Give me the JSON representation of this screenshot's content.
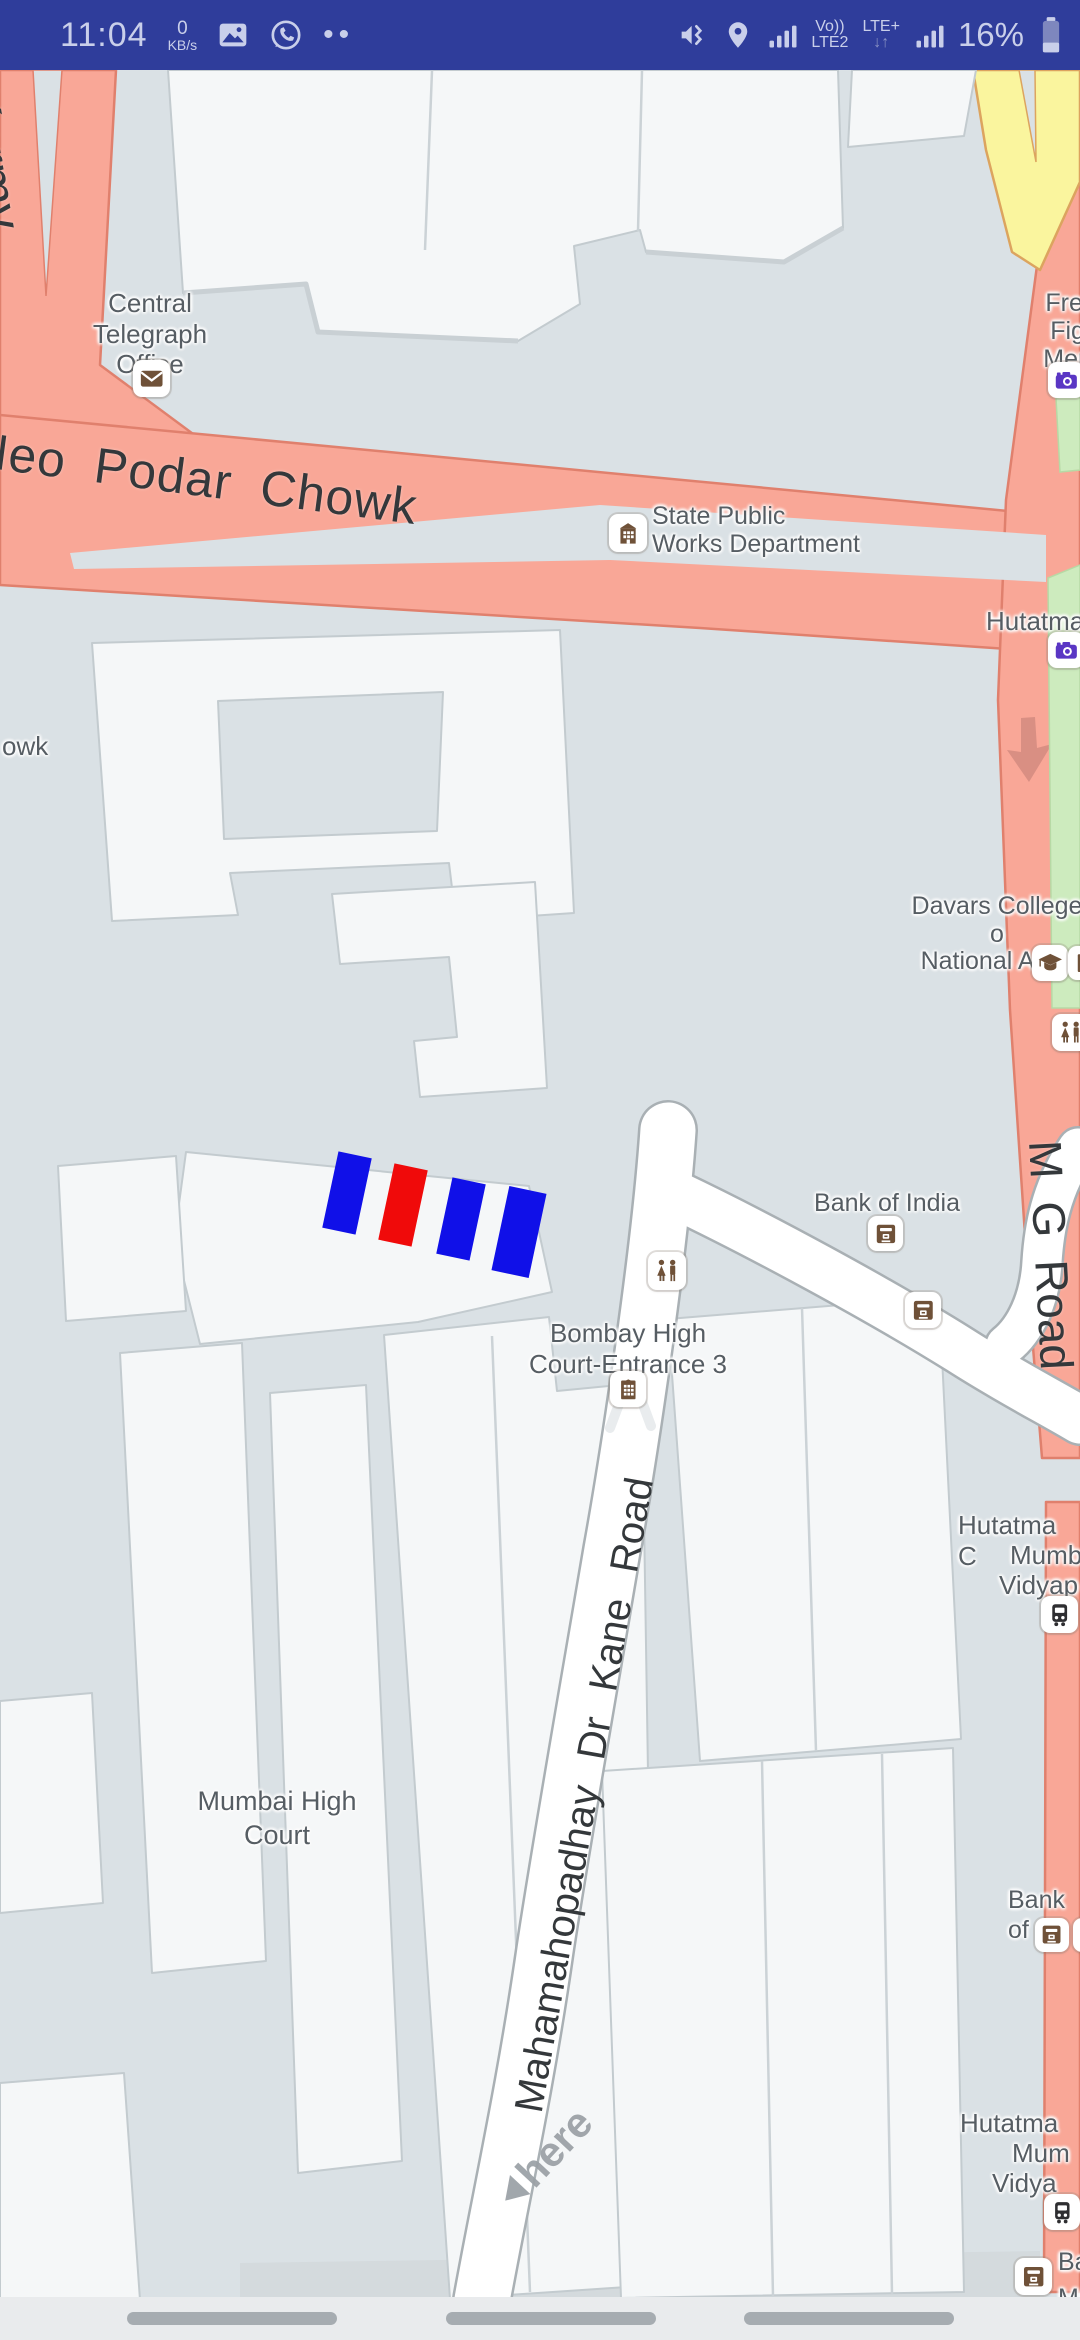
{
  "status_bar": {
    "time": "11:04",
    "net_speed_value": "0",
    "net_speed_unit": "KB/s",
    "notification_dots": "••",
    "volte_top": "Vo))",
    "volte_bottom": "LTE2",
    "lte_top": "LTE+",
    "lte_arrows": "↓↑",
    "battery_percent": "16%",
    "bg_color": "#2F3D9B",
    "icons": [
      "image-notification-icon",
      "whatsapp-notification-icon",
      "vibrate-icon",
      "location-icon",
      "signal-bars-icon",
      "signal-bars-icon",
      "battery-icon"
    ]
  },
  "map": {
    "attribution": "here",
    "road_labels": {
      "karmveer": "Karmv",
      "podar_chowk": "Neo Podar Chowk",
      "chowk_fragment": "owk",
      "mg_road": "M G Road",
      "kane_road": "Mahamahopadhay Dr Kane Road"
    },
    "poi": {
      "central_telegraph_office": {
        "label": "Central\nTelegraph\nOffice",
        "icon": "post-office"
      },
      "state_pwd": {
        "label": "State Public\nWorks Department",
        "icon": "government-building"
      },
      "freedom_fighters_memorial": {
        "label": "Freed\nFight\nMemo",
        "icon": "camera"
      },
      "hutatma_top": {
        "label": "Hutatma",
        "icon": "camera"
      },
      "davars_college": {
        "label": "Davars College o\nNational Asso",
        "icon": "college"
      },
      "restroom_right": {
        "icon": "restroom"
      },
      "bank_of_india": {
        "label": "Bank of India",
        "icon": "atm"
      },
      "restroom_road": {
        "icon": "restroom"
      },
      "atm_second": {
        "icon": "atm"
      },
      "bombay_high_court_entrance": {
        "label": "Bombay High\nCourt-Entrance 3",
        "icon": "building"
      },
      "hutatma_mid": {
        "line1": "Hutatma C",
        "line2": "Mumb",
        "line3": "Vidyap",
        "icon": "tram"
      },
      "mumbai_high_court": {
        "label": "Mumbai High\nCourt"
      },
      "bank_of_right": {
        "label": "Bank of",
        "icon": "atm"
      },
      "hutatma_low": {
        "line1": "Hutatma",
        "line2": "Mum",
        "line3": "Vidya",
        "icon": "tram"
      },
      "bank_bottom": {
        "line1": "Ba",
        "line2": "Mu",
        "icon": "atm"
      }
    },
    "colors": {
      "road_major": "#F9A797",
      "road_highway": "#FAF59E",
      "road_minor": "#FFFFFF",
      "building": "#F5F7F8",
      "land": "#DAE1E5",
      "park": "#CDEBBE",
      "marker_blue": "#1010E8",
      "marker_red": "#F00A0A"
    }
  }
}
